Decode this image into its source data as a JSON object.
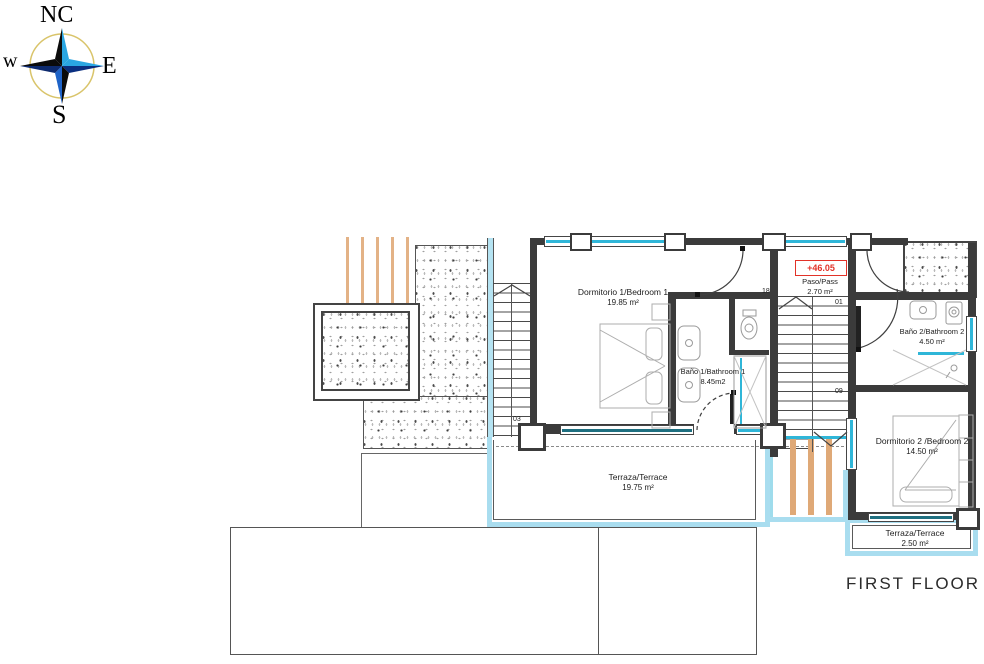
{
  "title": "FIRST FLOOR",
  "compass": {
    "n": "NC",
    "e": "E",
    "s": "S",
    "w": "w"
  },
  "elevation_marker": "+46.05",
  "rooms": {
    "bedroom1": {
      "name": "Dormitorio 1/Bedroom 1",
      "area": "19.85 m²"
    },
    "bathroom1": {
      "name": "Baño 1/Bathroom 1",
      "area": "8.45m2"
    },
    "pass": {
      "name": "Paso/Pass",
      "area": "2.70 m²"
    },
    "bathroom2": {
      "name": "Baño 2/Bathroom 2",
      "area": "4.50 m²"
    },
    "bedroom2": {
      "name": "Dormitorio 2 /Bedroom 2",
      "area": "14.50 m²"
    },
    "terrace1": {
      "name": "Terraza/Terrace",
      "area": "19.75 m²"
    },
    "terrace2": {
      "name": "Terraza/Terrace",
      "area": "2.50 m²"
    }
  },
  "stair_labels": {
    "s18": "18",
    "s01": "01",
    "s09": "09",
    "s03": "03"
  },
  "colors": {
    "wall": "#3b3b3b",
    "window_cyan": "#2fb6d8",
    "glazing_teal": "#1e6f80",
    "terrace_border": "#a9ddef",
    "beam_orange": "#dfa977",
    "elevation_red": "#e23228",
    "furniture_gray": "#adadad",
    "compass_blue": "#2aa6e2",
    "compass_navy": "#0a2f80"
  }
}
